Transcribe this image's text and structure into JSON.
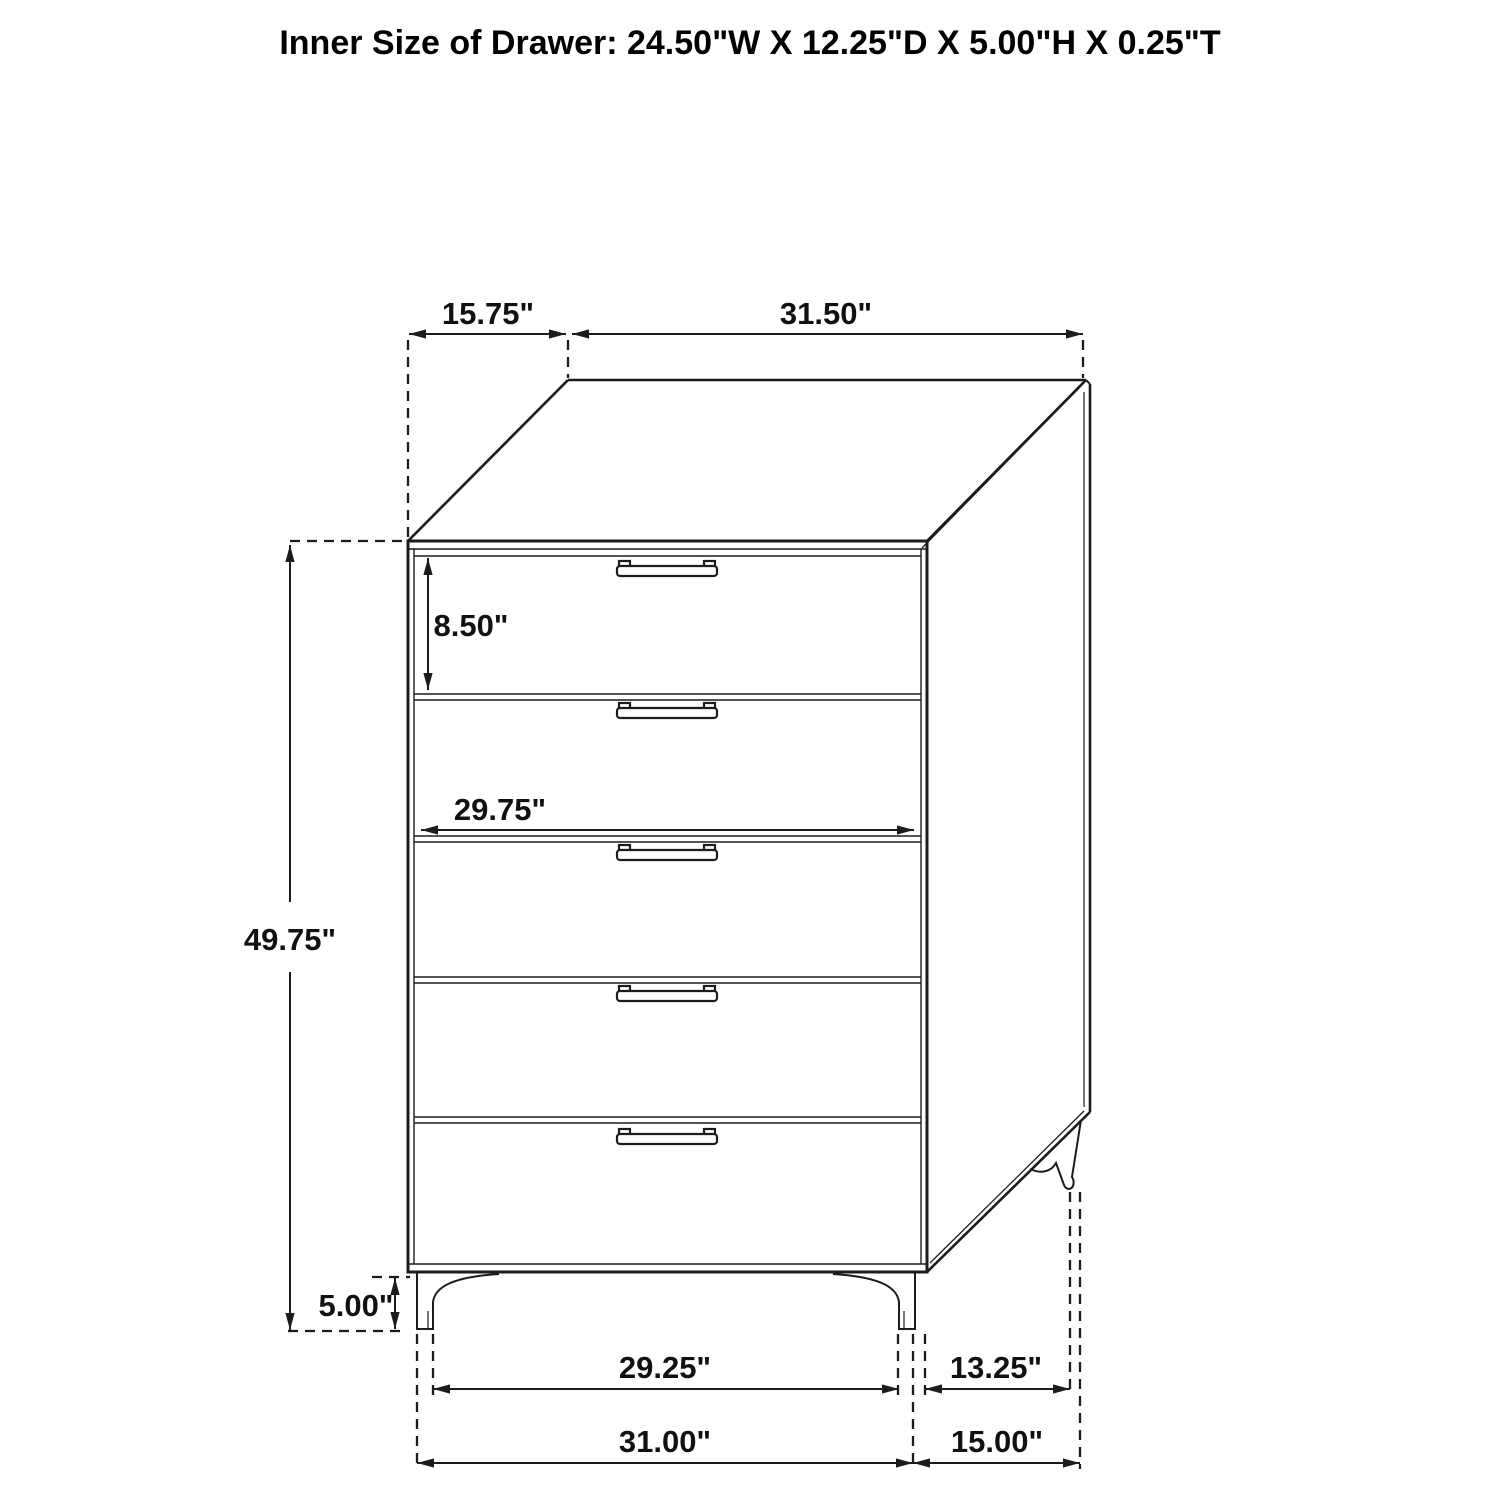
{
  "title": "Inner Size of Drawer: 24.50\"W X 12.25\"D X 5.00\"H X 0.25\"T",
  "diagram": {
    "item": "5-drawer chest dimension drawing",
    "drawer_count": 5,
    "labels": {
      "top_depth": "15.75\"",
      "top_width": "31.50\"",
      "top_drawer_height": "8.50\"",
      "drawer_opening_width": "29.75\"",
      "overall_height": "49.75\"",
      "leg_height": "5.00\"",
      "front_leg_span": "29.25\"",
      "front_base_width": "31.00\"",
      "side_leg_span": "13.25\"",
      "side_base_depth": "15.00\""
    },
    "colors": {
      "line": "#1c1c1c",
      "background": "#ffffff"
    }
  }
}
